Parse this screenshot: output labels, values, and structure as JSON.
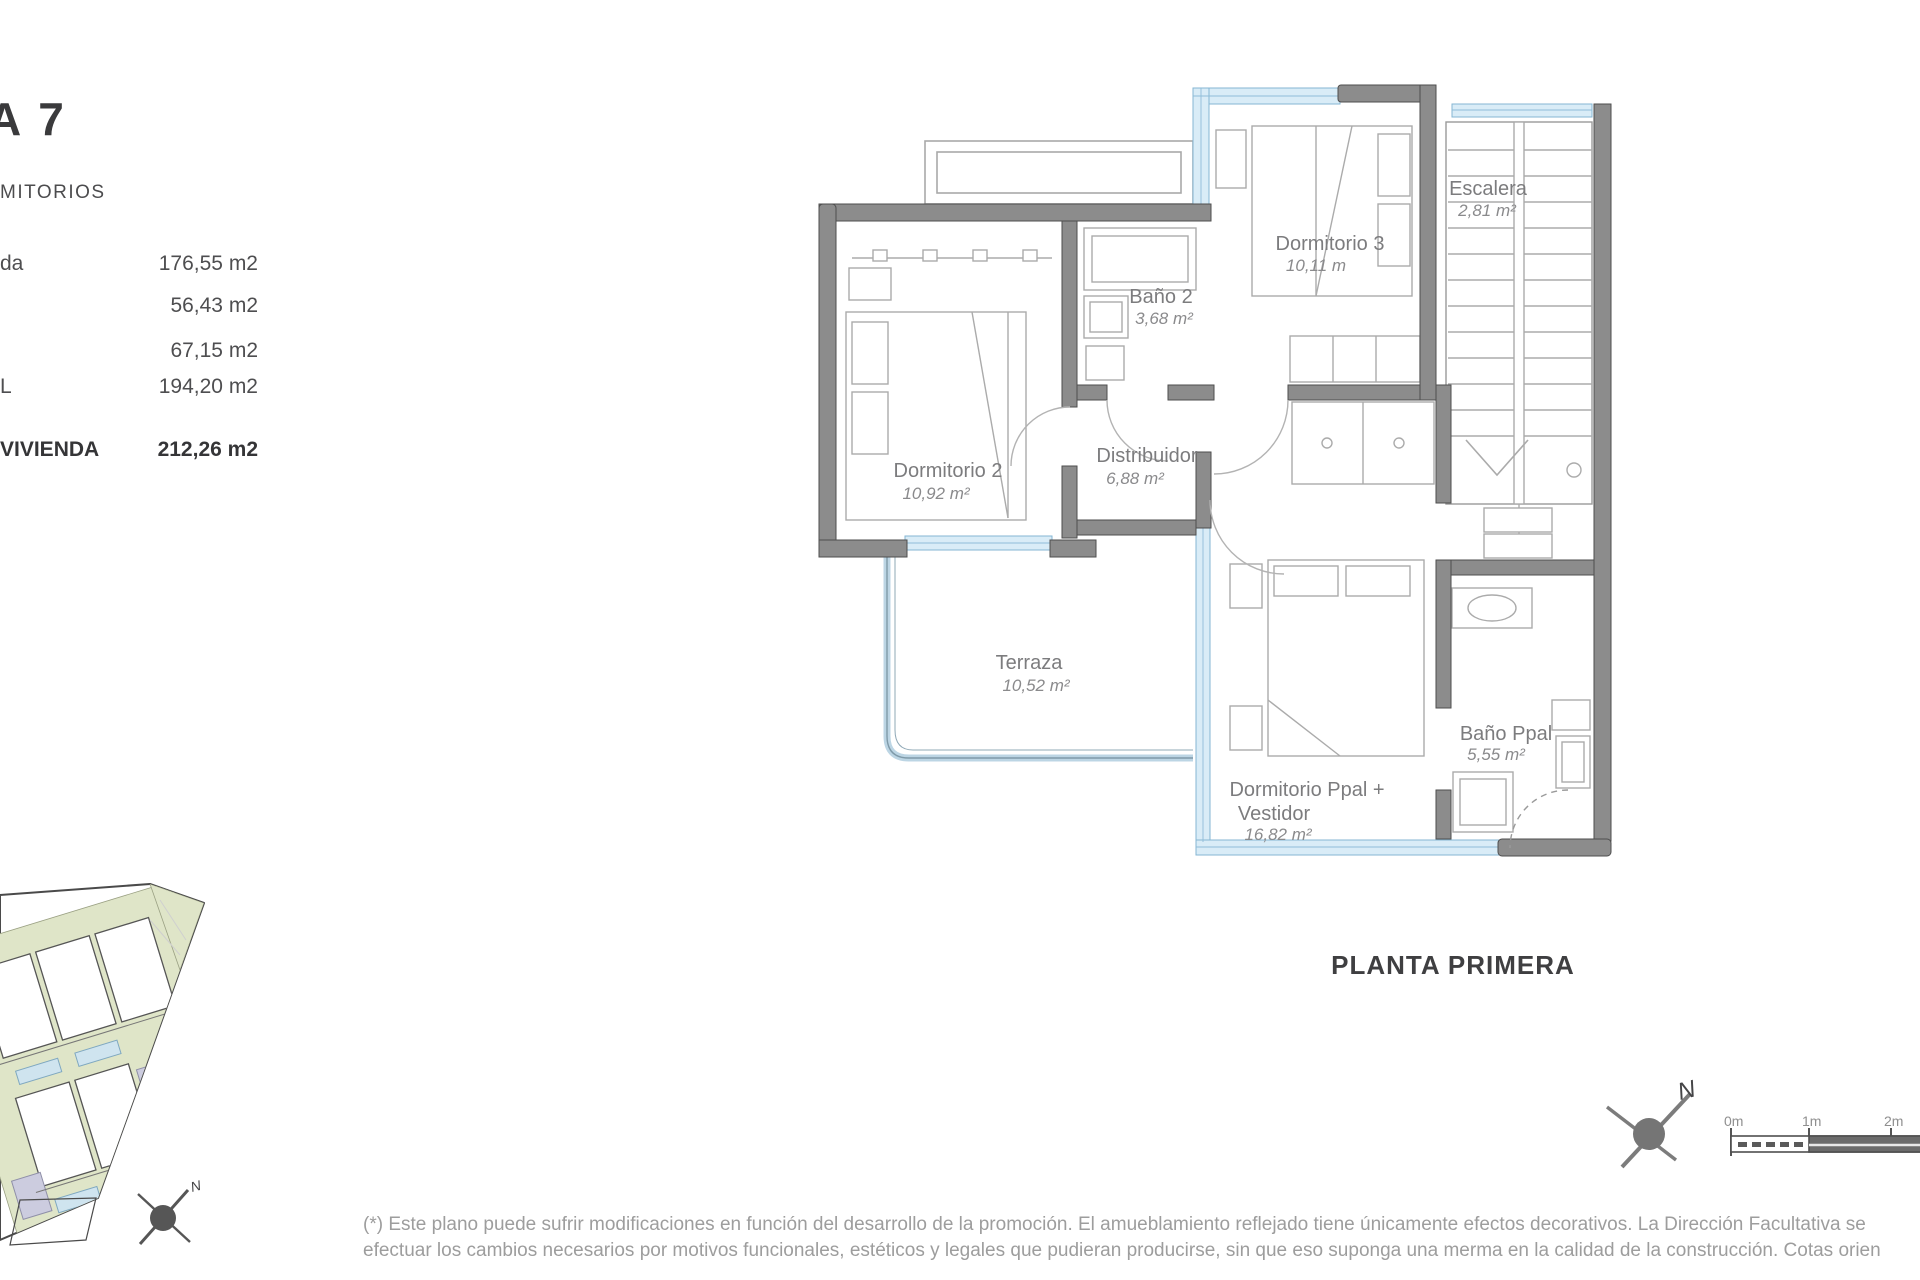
{
  "sidebar": {
    "title": "A 7",
    "subtitle": "MITORIOS",
    "rows": [
      {
        "label": "da",
        "value": "176,55 m2"
      },
      {
        "label": "",
        "value": "56,43 m2"
      },
      {
        "label": "",
        "value": "67,15 m2"
      },
      {
        "label": "L",
        "value": "194,20 m2"
      }
    ],
    "total": {
      "label": "VIVIENDA",
      "value": "212,26 m2"
    }
  },
  "plan": {
    "title": "PLANTA PRIMERA",
    "rooms": [
      {
        "name": "Dormitorio 2",
        "area": "10,92 m²"
      },
      {
        "name": "Baño 2",
        "area": "3,68 m²"
      },
      {
        "name": "Dormitorio 3",
        "area": "10,11 m"
      },
      {
        "name": "Escalera",
        "area": "2,81 m²"
      },
      {
        "name": "Distribuidor",
        "area": "6,88 m²"
      },
      {
        "name": "Terraza",
        "area": "10,52 m²"
      },
      {
        "name": "Dormitorio Ppal +",
        "name2": "Vestidor",
        "area": "16,82 m²"
      },
      {
        "name": "Baño Ppal",
        "area": "5,55 m²"
      }
    ]
  },
  "scale_bar": {
    "labels": [
      "0m",
      "1m",
      "2m"
    ]
  },
  "compass": {
    "label": "N"
  },
  "site_plan": {
    "compass_label": "N"
  },
  "footnote": {
    "line1": "(*) Este plano puede sufrir modificaciones en función del desarrollo de la promoción. El amueblamiento reflejado tiene únicamente efectos decorativos. La Dirección Facultativa se",
    "line2": "efectuar los cambios necesarios por motivos funcionales, estéticos y legales que pudieran producirse, sin que eso suponga una merma en la calidad de la construcción. Cotas orien"
  },
  "colors": {
    "wall_gray": "#8c8c8c",
    "glazing_blue": "#d9ecf7",
    "label_gray": "#7c7c7e",
    "site_green": "#dfe5c8",
    "site_lavender": "#ccccdf"
  }
}
